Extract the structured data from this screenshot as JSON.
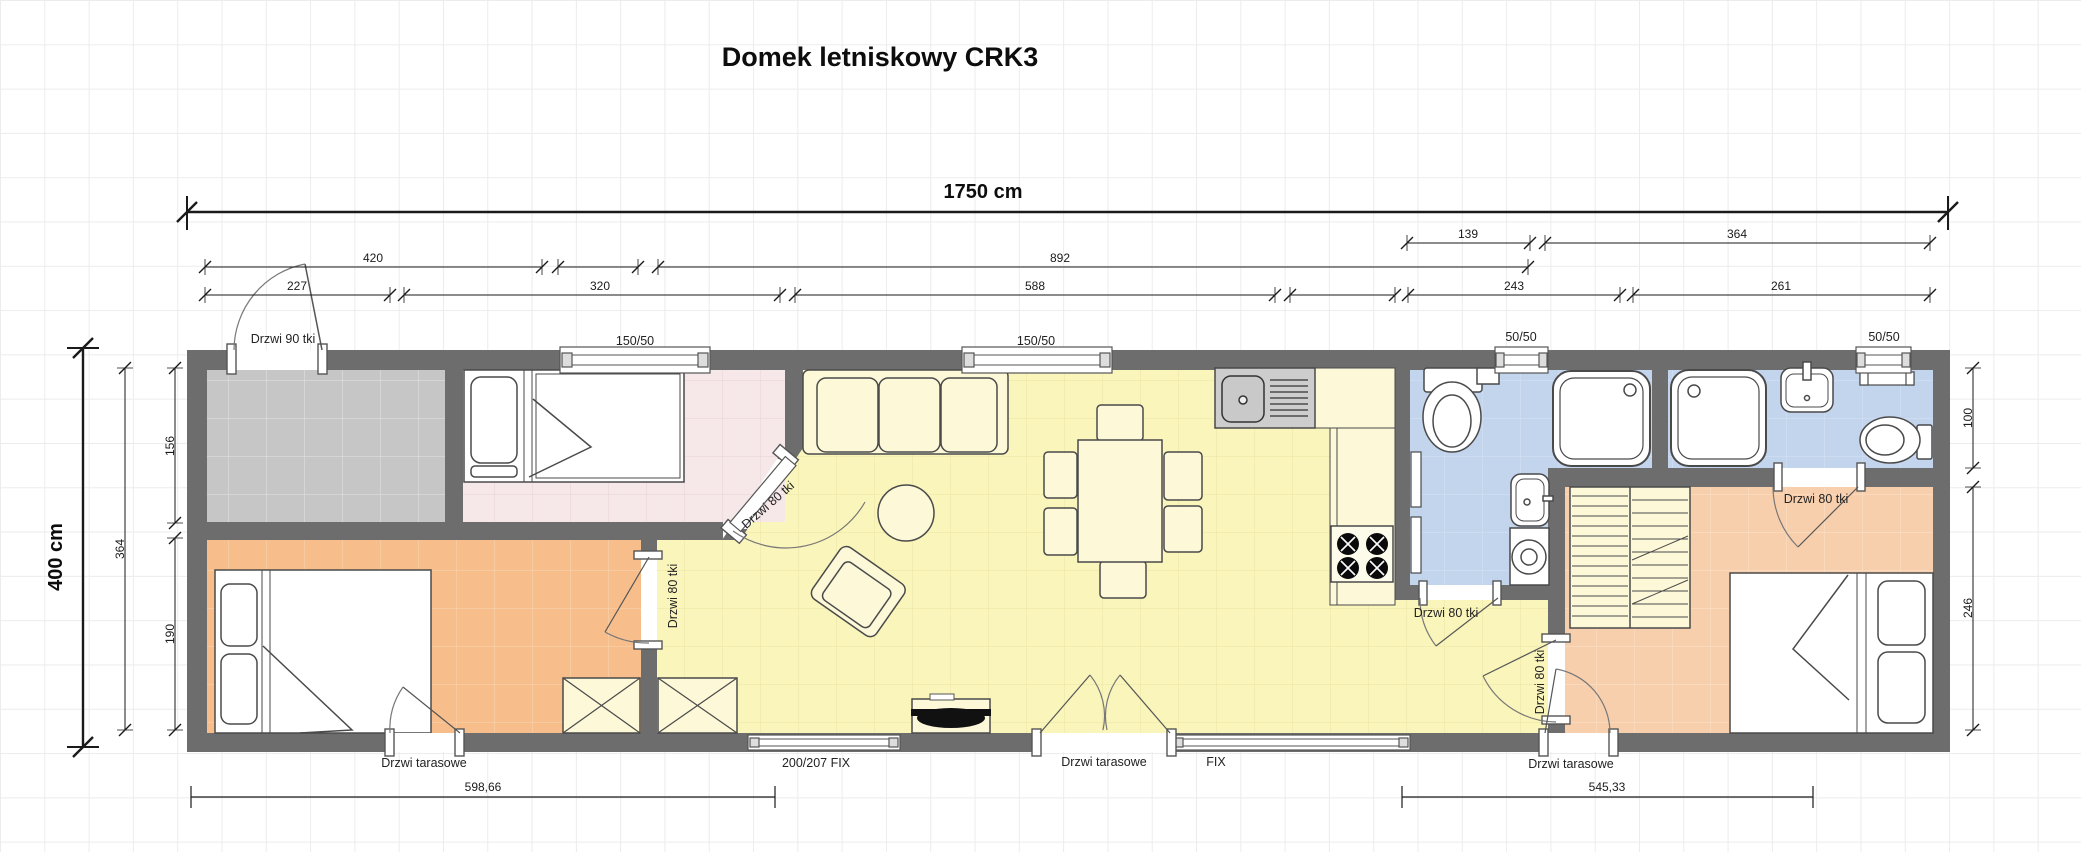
{
  "title": "Domek letniskowy CRK3",
  "dimensions": {
    "total_width": "1750 cm",
    "total_height": "400 cm",
    "top_row_inner": [
      "139",
      "364"
    ],
    "top_row_mid": [
      "420",
      "892"
    ],
    "top_row_outer": [
      "227",
      "320",
      "588",
      "243",
      "261"
    ],
    "left_interior": "364",
    "left_rooms": [
      "156",
      "190"
    ],
    "right_rooms": [
      "100",
      "246"
    ],
    "bottom_segments": [
      "598,66",
      "545,33"
    ]
  },
  "openings": {
    "entry_door": "Drzwi 90 tki",
    "interior_door": "Drzwi 80 tki",
    "terrace_door": "Drzwi tarasowe",
    "window_large": "150/50",
    "window_small": "50/50",
    "fixed_glazing_large": "200/207 FIX",
    "fixed_glazing": "FIX"
  },
  "colors": {
    "wall": "#6D6D6D",
    "floor_entry": "#C6C6C6",
    "floor_bedroom_pink": "#F6E7E8",
    "floor_bedroom_orange": "#F7BE8C",
    "floor_bedroom_peach": "#F8CFAC",
    "floor_living_yellow": "#FAF5BB",
    "floor_bathroom_blue": "#C3D4ED",
    "furniture_fill": "#FCF8D8"
  }
}
